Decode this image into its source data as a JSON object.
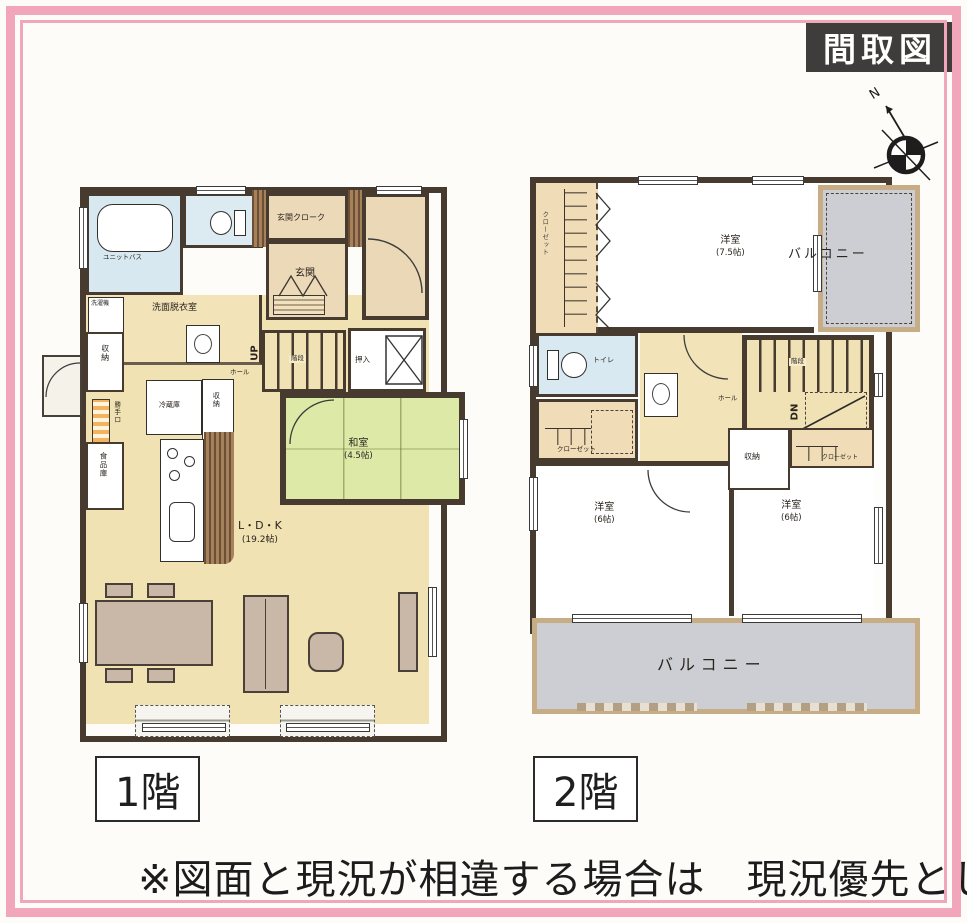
{
  "header": {
    "title": "間取図"
  },
  "compass": {
    "north_label": "N"
  },
  "colors": {
    "wall": "#473a2f",
    "frame_pink": "#f2a6ba",
    "floor_tan": "#f0e2b2",
    "entrance_tan": "#ecd9b8",
    "tatami_green": "#dde9a6",
    "water_blue": "#d7e8f0",
    "balcony_gray": "#cdced3",
    "wood_brown": "#8a6747",
    "badge_bg": "#3f3d3b"
  },
  "floor1": {
    "label": "1階",
    "rooms": {
      "bath": {
        "label": "ユニットバス"
      },
      "entrance_cloak": {
        "label": "玄関クローク"
      },
      "entrance": {
        "label": "玄関"
      },
      "washroom": {
        "label": "洗面脱衣室"
      },
      "washer": {
        "label": "洗濯機"
      },
      "storage_left": {
        "label": "収納"
      },
      "back_door": {
        "label": "勝手口"
      },
      "pantry": {
        "label": "食品庫"
      },
      "fridge": {
        "label": "冷蔵庫"
      },
      "storage_mid": {
        "label": "収納"
      },
      "stairs": {
        "label": "階段",
        "up": "UP"
      },
      "hall": {
        "label": "ホール"
      },
      "oshiire": {
        "label": "押入"
      },
      "washitsu": {
        "label": "和室",
        "size": "(4.5帖)"
      },
      "ldk": {
        "label": "L・D・K",
        "size": "(19.2帖)"
      }
    }
  },
  "floor2": {
    "label": "2階",
    "rooms": {
      "bedroom_75": {
        "label": "洋室",
        "size": "(7.5帖)"
      },
      "closet_left": {
        "label": "クローゼット"
      },
      "balcony_top": {
        "label": "バルコニー"
      },
      "toilet": {
        "label": "トイレ"
      },
      "closet_mid": {
        "label": "クローゼット"
      },
      "hall": {
        "label": "ホール"
      },
      "stairs": {
        "label": "階段",
        "down": "DN"
      },
      "storage": {
        "label": "収納"
      },
      "closet_right": {
        "label": "クローゼット"
      },
      "bedroom_6l": {
        "label": "洋室",
        "size": "(6帖)"
      },
      "bedroom_6r": {
        "label": "洋室",
        "size": "(6帖)"
      },
      "balcony_bottom": {
        "label": "バルコニー"
      }
    }
  },
  "note": "※図面と現況が相違する場合は　現況優先とし"
}
